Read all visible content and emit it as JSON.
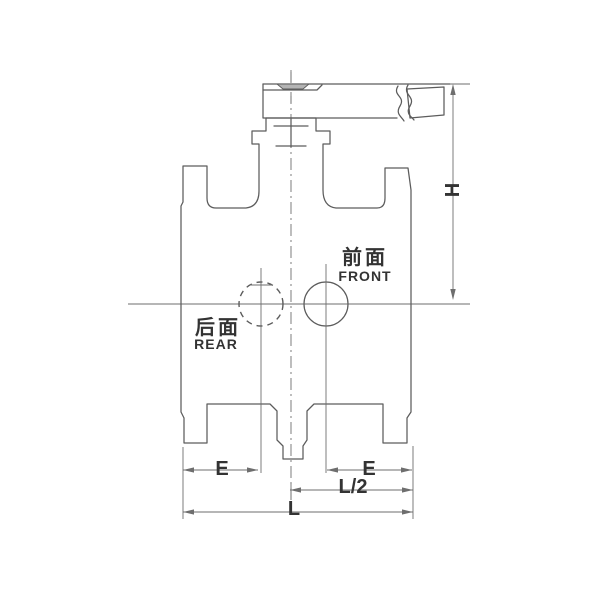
{
  "drawing": {
    "annotations": {
      "front": {
        "cn": "前面",
        "en": "FRONT"
      },
      "rear": {
        "cn": "后面",
        "en": "REAR"
      }
    },
    "dimensions": {
      "height": "H",
      "end_left": "E",
      "end_right": "E",
      "half_length": "L/2",
      "length": "L"
    },
    "colors": {
      "bg": "#ffffff",
      "line": "#5c5c5c",
      "thin": "#6e6e6e",
      "text": "#333333",
      "shade": "#b4b4b4"
    }
  }
}
